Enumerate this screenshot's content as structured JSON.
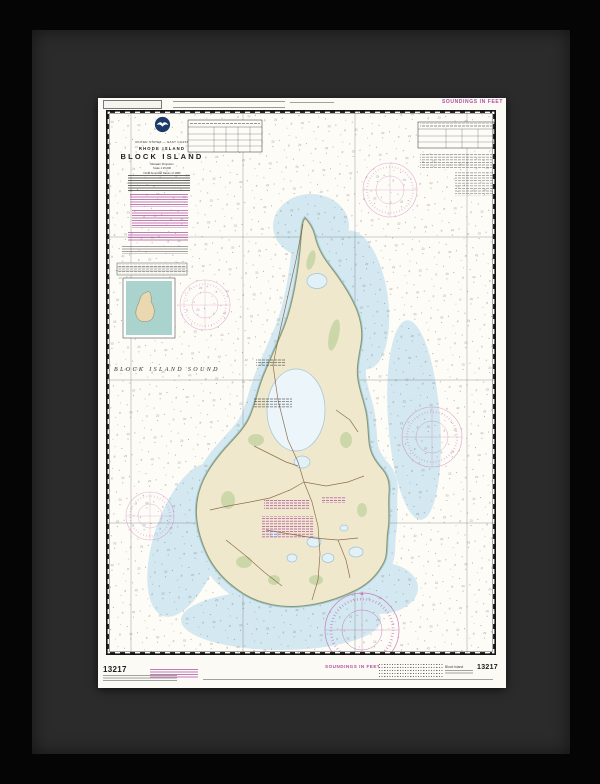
{
  "artwork": {
    "kind": "framed nautical chart",
    "frame_color": "#050505",
    "mat_color": "#2b2b2b",
    "paper_color": "#fbfaf5"
  },
  "chart": {
    "number": "13217",
    "soundings_note_top": "SOUNDINGS IN FEET",
    "header": {
      "country": "UNITED STATES — EAST COAST",
      "state": "RHODE ISLAND",
      "title": "BLOCK ISLAND",
      "projection": "Mercator Projection",
      "scale": "Scale 1:15,000",
      "datum": "North American Datum of 1983"
    },
    "sea_label": "BLOCK ISLAND SOUND",
    "bottom": {
      "chart_number_left": "13217",
      "chart_number_right": "13217",
      "soundings_label": "SOUNDINGS IN FEET",
      "edition_label": "Block Island"
    },
    "icons": [
      "noaa-emblem",
      "compass-rose"
    ],
    "colors": {
      "magenta_accent": "#b04fa4",
      "shallow_water": "#cfe6ef",
      "land_tan": "#f0e8cc",
      "marsh_green": "#c9d6a6",
      "pond_blue": "#e2f0f7",
      "inset_teal": "#a9d3cc"
    }
  }
}
